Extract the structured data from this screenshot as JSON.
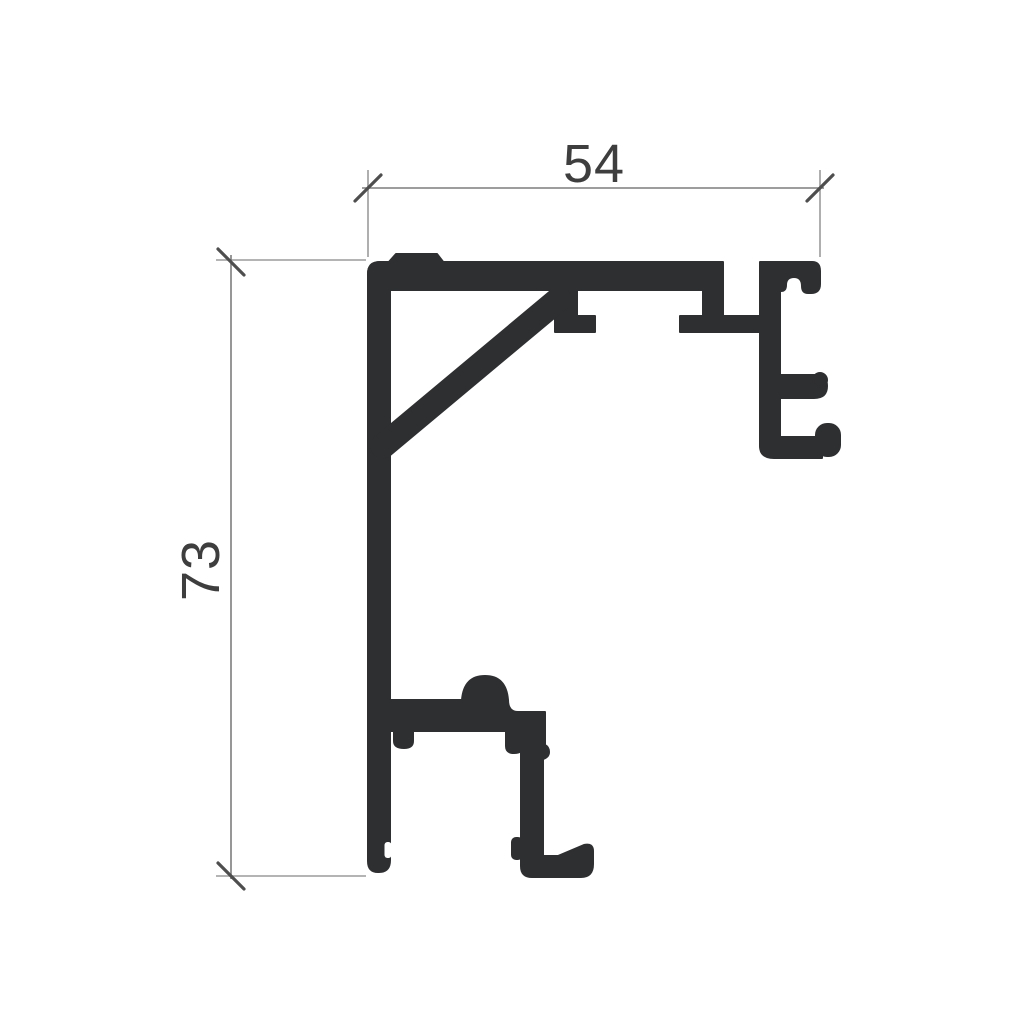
{
  "drawing": {
    "type": "technical_profile_cross_section",
    "background_color": "#ffffff",
    "profile_color": "#2e2f31",
    "dimension_line_color": "#7d7d7d",
    "extension_line_color": "#9b9b9b",
    "tick_color": "#4e4e4e",
    "text_color": "#3e3e3e",
    "dimensions": {
      "width": {
        "value": "54",
        "orientation": "horizontal",
        "position": "top"
      },
      "height": {
        "value": "73",
        "orientation": "vertical",
        "position": "left"
      }
    }
  }
}
